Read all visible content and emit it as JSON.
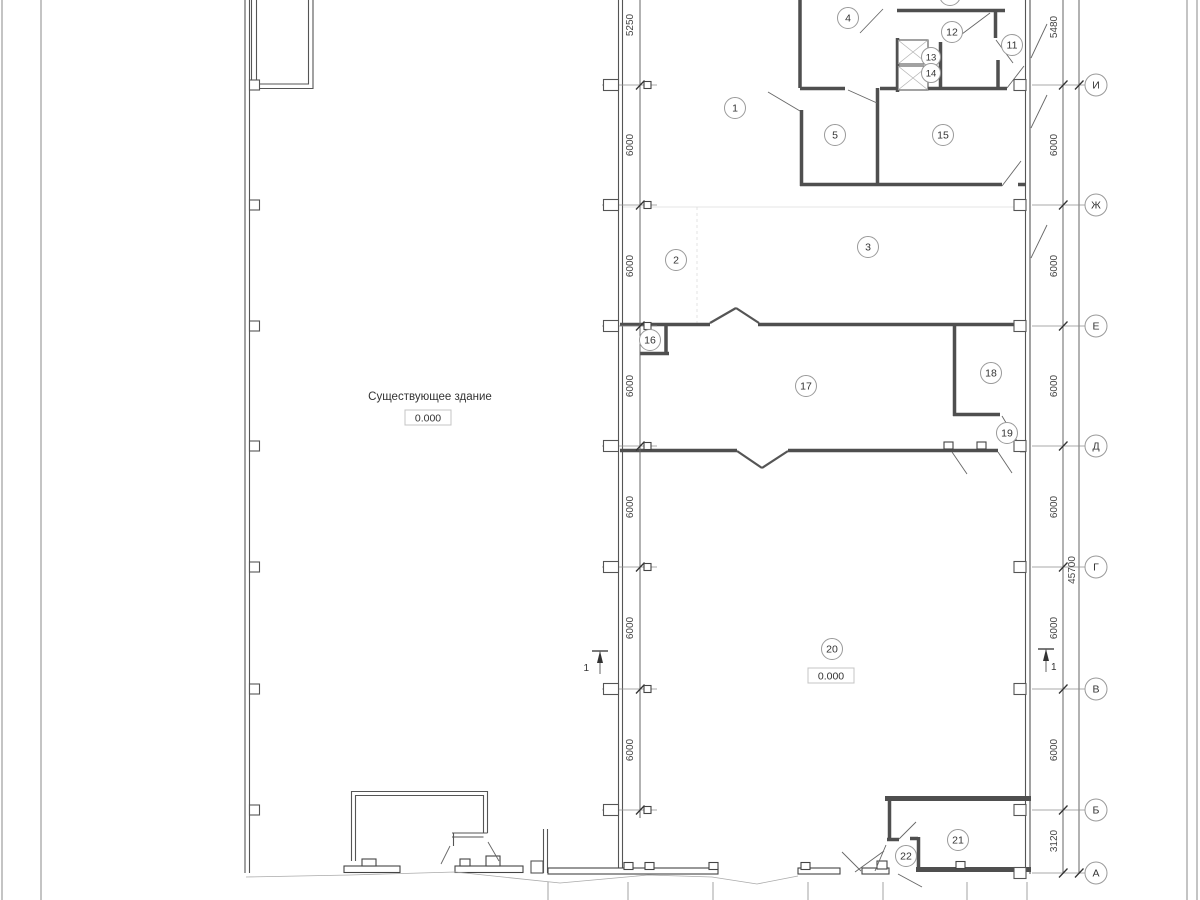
{
  "annotations": {
    "existing_building_label": "Существующее здание",
    "existing_building_elevation": "0.000",
    "hall_elevation": "0.000",
    "section_label_left": "1",
    "section_label_right": "1"
  },
  "rooms": {
    "r1": "1",
    "r2": "2",
    "r3": "3",
    "r4": "4",
    "r5": "5",
    "r11": "11",
    "r12": "12",
    "r13": "13",
    "r14": "14",
    "r15": "15",
    "r16": "16",
    "r17": "17",
    "r18": "18",
    "r19": "19",
    "r20": "20",
    "r21": "21",
    "r22": "22"
  },
  "axes": {
    "i": "И",
    "zh": "Ж",
    "e": "Е",
    "d": "Д",
    "g": "Г",
    "v": "В",
    "b": "Б",
    "a": "А"
  },
  "dimensions": {
    "left": {
      "d0": "5250",
      "d1": "6000",
      "d2": "6000",
      "d3": "6000",
      "d4": "6000",
      "d5": "6000",
      "d6": "6000"
    },
    "right": {
      "d0": "5480",
      "d1": "6000",
      "d2": "6000",
      "d3": "6000",
      "d4": "6000",
      "d5": "6000",
      "d6": "6000",
      "d7": "3120"
    },
    "overall": "45700"
  },
  "colors": {
    "wall": "#4f4f4f",
    "line": "#555555",
    "annotation": "#444444",
    "circle_stroke": "#9a9a9a"
  }
}
